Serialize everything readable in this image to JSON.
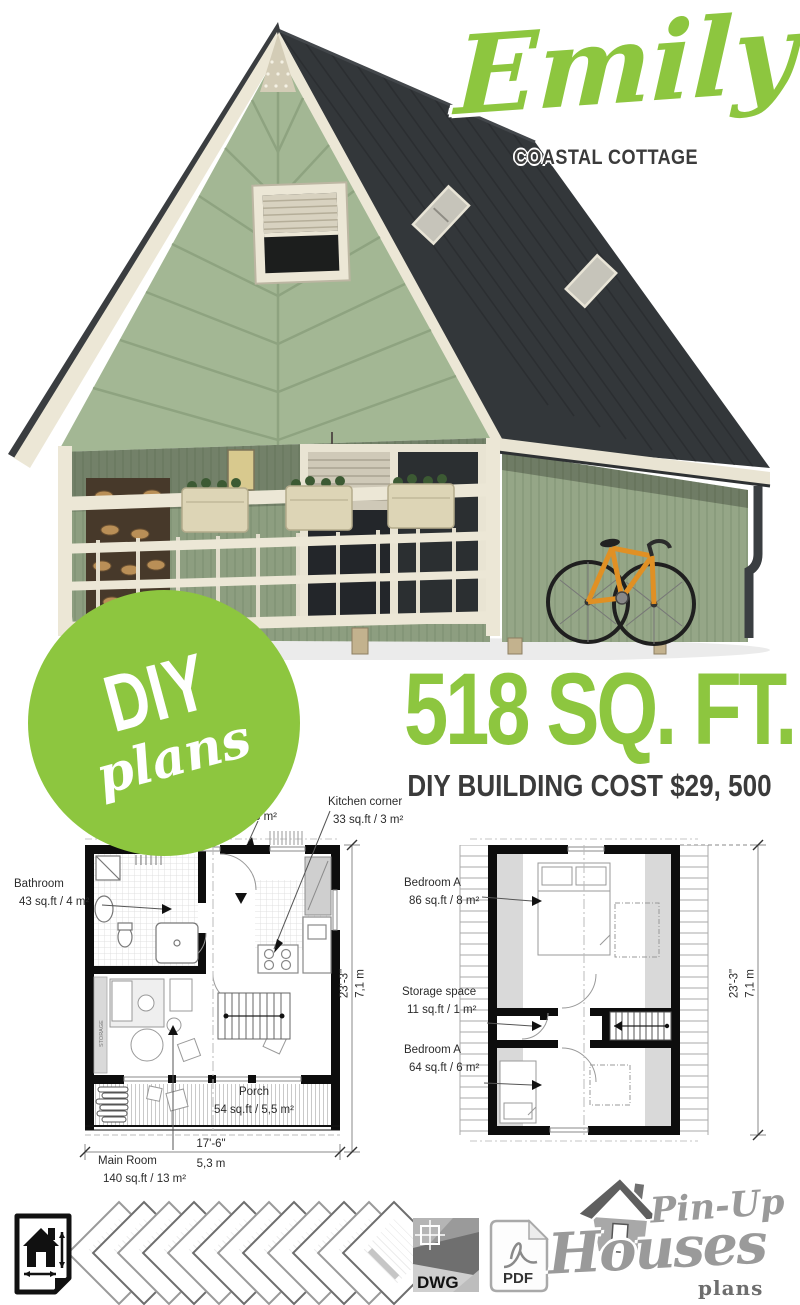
{
  "header": {
    "title": "Emily",
    "subtitle": "COASTAL COTTAGE"
  },
  "badge": {
    "diy": "DIY",
    "plans": "plans"
  },
  "stats": {
    "area": "518 SQ. FT.",
    "cost": "DIY BUILDING COST $29, 500"
  },
  "colors": {
    "accent_green": "#8dc63f",
    "dark_text": "#3b3b3b",
    "roof": "#33373a",
    "siding": "#a3b794",
    "trim": "#ece7d6",
    "bike_orange": "#e09024",
    "logo_gray": "#9a9a9a"
  },
  "ground_floor": {
    "kitchen_label": "Kitchen corner",
    "kitchen_area": "33 sq.ft / 3 m²",
    "hidden_area_fragment": "3 m²",
    "bathroom_label": "Bathroom",
    "bathroom_area": "43 sq.ft / 4 m²",
    "porch_label": "Porch",
    "porch_area": "54 sq.ft / 5,5 m²",
    "main_room_label": "Main Room",
    "main_room_area": "140 sq.ft / 13 m²",
    "storage_band": "STORAGE",
    "width_ft": "17'-6\"",
    "width_m": "5,3 m",
    "depth_ft": "23'-3\"",
    "depth_m": "7,1 m"
  },
  "upper_floor": {
    "bedroom_a_label": "Bedroom A",
    "bedroom_a_area": "86 sq.ft / 8 m²",
    "storage_label": "Storage space",
    "storage_area": "11 sq.ft / 1 m²",
    "bedroom_b_label": "Bedroom A",
    "bedroom_b_area": "64 sq.ft / 6 m²",
    "depth_ft": "23'-3\"",
    "depth_m": "7,1 m"
  },
  "footer": {
    "dwg": "DWG",
    "pdf": "PDF",
    "logo_pinup": "Pin-Up",
    "logo_houses": "Houses",
    "logo_plans": "plans"
  }
}
